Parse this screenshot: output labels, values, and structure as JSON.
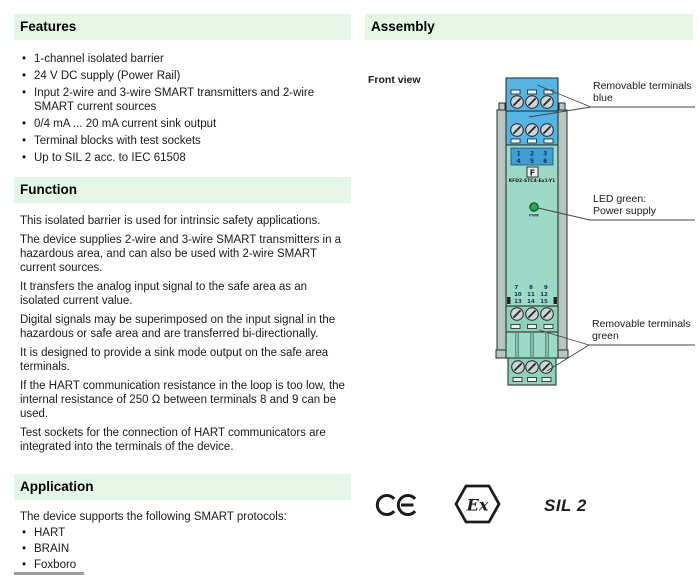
{
  "ui": {
    "bullet": "•"
  },
  "left": {
    "features": {
      "title": "Features",
      "items": [
        "1-channel isolated barrier",
        "24 V DC supply (Power Rail)",
        "Input 2-wire and 3-wire SMART transmitters and 2-wire SMART current sources",
        "0/4 mA ... 20 mA current sink output",
        "Terminal blocks with test sockets",
        "Up to SIL 2 acc. to IEC 61508"
      ]
    },
    "function": {
      "title": "Function",
      "paragraphs": [
        "This isolated barrier is used for intrinsic safety applications.",
        "The device supplies 2-wire and 3-wire SMART transmitters in a hazardous area, and can also be used with 2-wire SMART current sources.",
        "It transfers the analog input signal to the safe area as an isolated current value.",
        "Digital signals may be superimposed on the input signal in the hazardous or safe area and are transferred bi-directionally.",
        "It is designed to provide a sink mode output on the safe area terminals.",
        "If the HART communication resistance in the loop is too low, the internal resistance of 250 Ω between terminals 8 and 9 can be used.",
        "Test sockets for the connection of HART communicators are integrated into the terminals of the device."
      ]
    },
    "application": {
      "title": "Application",
      "intro": "The device supports the following SMART protocols:",
      "items": [
        "HART",
        "BRAIN",
        "Foxboro"
      ]
    }
  },
  "right": {
    "assembly": {
      "title": "Assembly",
      "front_view": "Front view",
      "callout_terminals_blue": {
        "line1": "Removable terminals",
        "line2": "blue"
      },
      "callout_led": {
        "line1": "LED green:",
        "line2": "Power supply"
      },
      "callout_terminals_green": {
        "line1": "Removable terminals",
        "line2": "green"
      },
      "device": {
        "upper_numbers_row1": "1 2 3",
        "upper_numbers_row2": "4 5 6",
        "lower_numbers_row1": "7 8 9",
        "lower_numbers_row2": "10 11 12",
        "lower_numbers_row3": "13 14 15",
        "led_label": "PWR",
        "model": "KFD2-STC4-Ex1-Y1",
        "logo_glyph": "F"
      },
      "marks": {
        "ce": "CE",
        "ex": "Ex",
        "sil": "SIL 2"
      }
    }
  },
  "colors": {
    "section_header_bg": "#e4f7e6",
    "terminal_blue": "#55b4e3",
    "panel_blue": "#3f9fd4",
    "body_teal": "#9cd9c7",
    "terminal_green": "#8ed2ba",
    "rail_gray": "#b4c8c1",
    "led_green": "#2da44e"
  }
}
